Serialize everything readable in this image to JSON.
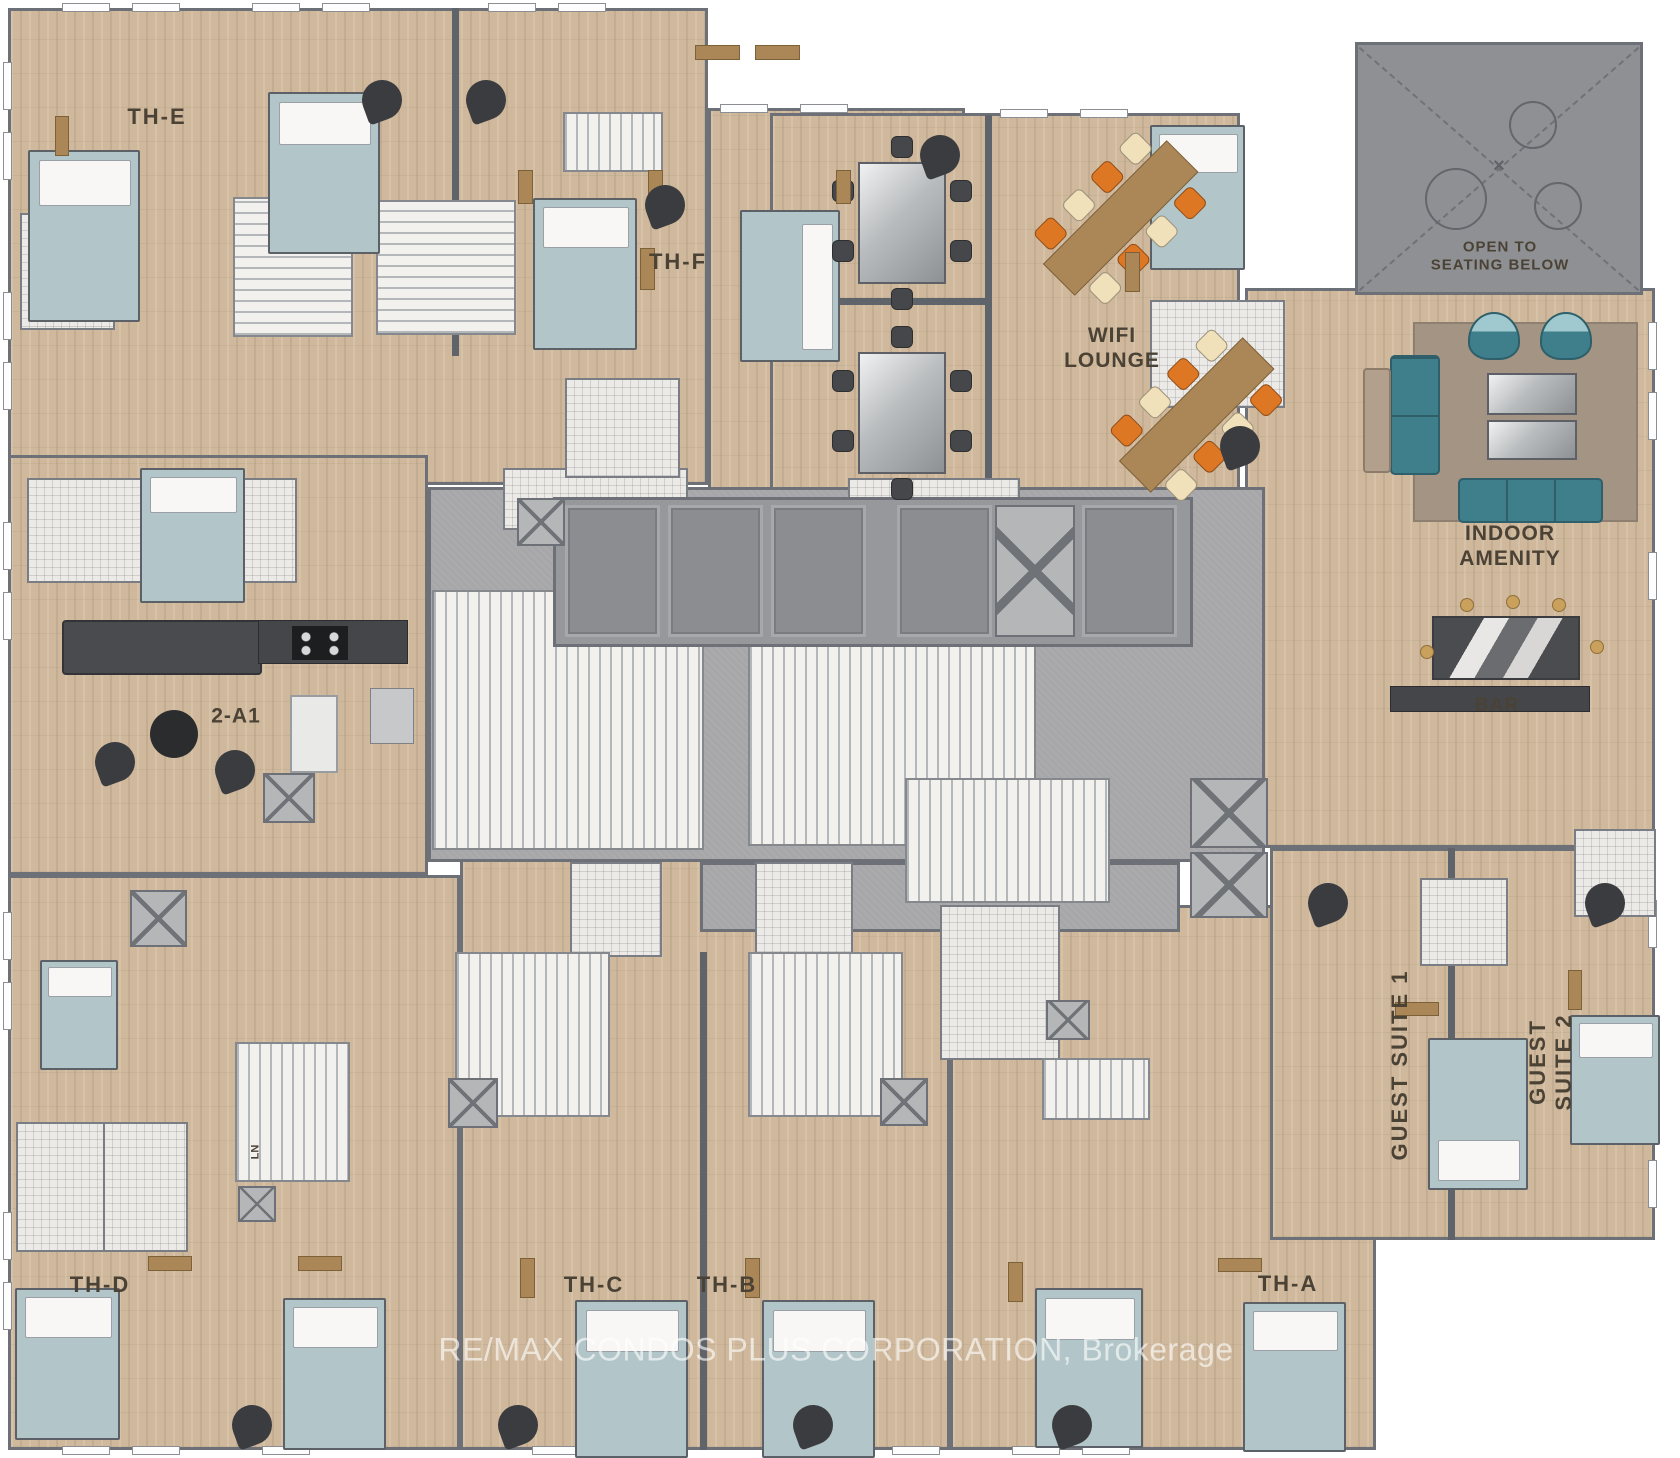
{
  "watermark": "RE/MAX CONDOS PLUS CORPORATION, Brokerage",
  "palette": {
    "wood": "#cfb89b",
    "wall": "#6d7177",
    "corridor": "#a7a6a9",
    "open_below": "#8f9093",
    "bed": "#b2c5c8",
    "sofa_teal": "#3f7e8b",
    "chair_orange": "#dd7724",
    "chair_cream": "#f1e1ba",
    "chair_dark": "#45474b",
    "table_wood": "#ab8758",
    "rug": "#a39483",
    "label_text": "#4b4236"
  },
  "labels": [
    {
      "text": "TH-E",
      "x": 157,
      "y": 117,
      "size": 22,
      "spacing": 2,
      "rotate": 0
    },
    {
      "text": "TH-F",
      "x": 678,
      "y": 262,
      "size": 22,
      "spacing": 2,
      "rotate": 0
    },
    {
      "text": "WIFI\nLOUNGE",
      "x": 1112,
      "y": 349,
      "size": 21,
      "spacing": 1,
      "rotate": 0
    },
    {
      "text": "OPEN TO\nSEATING BELOW",
      "x": 1500,
      "y": 256,
      "size": 15,
      "spacing": 1,
      "rotate": 0
    },
    {
      "text": "INDOOR AMENITY",
      "x": 1510,
      "y": 547,
      "size": 21,
      "spacing": 1,
      "rotate": 0
    },
    {
      "text": "BAR",
      "x": 1497,
      "y": 706,
      "size": 19,
      "spacing": 1,
      "rotate": 0
    },
    {
      "text": "2-A1",
      "x": 236,
      "y": 717,
      "size": 21,
      "spacing": 1,
      "rotate": 0
    },
    {
      "text": "LN",
      "x": 256,
      "y": 1152,
      "size": 11,
      "spacing": 0,
      "rotate": -90
    },
    {
      "text": "TH-D",
      "x": 100,
      "y": 1285,
      "size": 22,
      "spacing": 2,
      "rotate": 0
    },
    {
      "text": "TH-C",
      "x": 594,
      "y": 1285,
      "size": 22,
      "spacing": 2,
      "rotate": 0
    },
    {
      "text": "TH-B",
      "x": 727,
      "y": 1285,
      "size": 22,
      "spacing": 2,
      "rotate": 0
    },
    {
      "text": "TH-A",
      "x": 1288,
      "y": 1284,
      "size": 22,
      "spacing": 2,
      "rotate": 0
    },
    {
      "text": "GUEST SUITE 1",
      "x": 1400,
      "y": 1065,
      "size": 22,
      "spacing": 2,
      "rotate": -90
    },
    {
      "text": "GUEST SUITE 2",
      "x": 1551,
      "y": 1062,
      "size": 22,
      "spacing": 2,
      "rotate": -90
    }
  ],
  "regions": [
    {
      "k": "wood",
      "x": 8,
      "y": 8,
      "w": 700,
      "h": 477
    },
    {
      "k": "wood",
      "x": 708,
      "y": 108,
      "w": 257,
      "h": 385
    },
    {
      "k": "wood",
      "x": 770,
      "y": 113,
      "w": 470,
      "h": 392
    },
    {
      "k": "wood",
      "x": 1245,
      "y": 288,
      "w": 410,
      "h": 560
    },
    {
      "k": "wood",
      "x": 8,
      "y": 455,
      "w": 420,
      "h": 420
    },
    {
      "k": "wood",
      "x": 8,
      "y": 875,
      "w": 452,
      "h": 575
    },
    {
      "k": "wood",
      "x": 460,
      "y": 858,
      "w": 490,
      "h": 592
    },
    {
      "k": "wood",
      "x": 950,
      "y": 905,
      "w": 426,
      "h": 545
    },
    {
      "k": "wood",
      "x": 1270,
      "y": 848,
      "w": 385,
      "h": 392
    },
    {
      "k": "corridor",
      "x": 428,
      "y": 487,
      "w": 837,
      "h": 375
    },
    {
      "k": "corridor",
      "x": 700,
      "y": 862,
      "w": 480,
      "h": 70
    },
    {
      "k": "openbelow",
      "x": 1355,
      "y": 42,
      "w": 288,
      "h": 253
    }
  ],
  "walls": [
    [
      452,
      8,
      7,
      348
    ],
    [
      985,
      115,
      7,
      390
    ],
    [
      770,
      298,
      218,
      7
    ],
    [
      700,
      952,
      7,
      498
    ],
    [
      1448,
      848,
      7,
      392
    ]
  ],
  "windows": [
    [
      62,
      3,
      48,
      9
    ],
    [
      132,
      3,
      48,
      9
    ],
    [
      252,
      3,
      48,
      9
    ],
    [
      322,
      3,
      48,
      9
    ],
    [
      488,
      3,
      48,
      9
    ],
    [
      558,
      3,
      48,
      9
    ],
    [
      720,
      104,
      48,
      9
    ],
    [
      800,
      104,
      48,
      9
    ],
    [
      1000,
      109,
      48,
      9
    ],
    [
      1080,
      109,
      48,
      9
    ],
    [
      3,
      62,
      9,
      48
    ],
    [
      3,
      132,
      9,
      48
    ],
    [
      3,
      292,
      9,
      48
    ],
    [
      3,
      362,
      9,
      48
    ],
    [
      3,
      522,
      9,
      48
    ],
    [
      3,
      592,
      9,
      48
    ],
    [
      3,
      912,
      9,
      48
    ],
    [
      3,
      982,
      9,
      48
    ],
    [
      3,
      1212,
      9,
      48
    ],
    [
      3,
      1282,
      9,
      48
    ],
    [
      62,
      1446,
      48,
      9
    ],
    [
      132,
      1446,
      48,
      9
    ],
    [
      262,
      1446,
      48,
      9
    ],
    [
      532,
      1446,
      48,
      9
    ],
    [
      602,
      1446,
      48,
      9
    ],
    [
      822,
      1446,
      48,
      9
    ],
    [
      892,
      1446,
      48,
      9
    ],
    [
      1012,
      1446,
      48,
      9
    ],
    [
      1082,
      1446,
      48,
      9
    ],
    [
      1648,
      322,
      9,
      48
    ],
    [
      1648,
      392,
      9,
      48
    ],
    [
      1648,
      552,
      9,
      48
    ],
    [
      1648,
      900,
      9,
      48
    ],
    [
      1648,
      1090,
      9,
      48
    ],
    [
      1648,
      1160,
      9,
      48
    ]
  ],
  "tiles": [
    [
      20,
      213,
      95,
      117
    ],
    [
      27,
      478,
      270,
      105
    ],
    [
      503,
      468,
      185,
      62
    ],
    [
      565,
      378,
      115,
      100
    ],
    [
      848,
      478,
      172,
      58
    ],
    [
      1150,
      300,
      135,
      108
    ],
    [
      570,
      862,
      92,
      95
    ],
    [
      755,
      862,
      98,
      95
    ],
    [
      940,
      905,
      120,
      155
    ],
    [
      16,
      1122,
      90,
      130
    ],
    [
      103,
      1122,
      85,
      130
    ],
    [
      1420,
      878,
      88,
      88
    ],
    [
      1574,
      829,
      82,
      88
    ]
  ],
  "stairs": [
    [
      233,
      197,
      120,
      140,
      "h"
    ],
    [
      376,
      200,
      140,
      135,
      "h"
    ],
    [
      563,
      112,
      100,
      60,
      "v"
    ],
    [
      432,
      590,
      272,
      260,
      "v"
    ],
    [
      748,
      578,
      288,
      268,
      "v"
    ],
    [
      905,
      778,
      205,
      125,
      "v"
    ],
    [
      235,
      1042,
      115,
      140,
      "v"
    ],
    [
      455,
      952,
      155,
      165,
      "v"
    ],
    [
      748,
      952,
      155,
      165,
      "v"
    ],
    [
      1042,
      1058,
      108,
      62,
      "v"
    ]
  ],
  "elevator_bank": {
    "x": 553,
    "y": 497,
    "w": 640,
    "h": 150,
    "cars": [
      [
        565,
        505,
        95,
        132
      ],
      [
        668,
        505,
        95,
        132
      ],
      [
        771,
        505,
        95,
        132
      ],
      [
        897,
        505,
        95,
        132
      ],
      [
        1082,
        505,
        95,
        132
      ]
    ],
    "xshaft": [
      995,
      505,
      80,
      132
    ]
  },
  "shafts": [
    [
      517,
      498,
      48,
      48
    ],
    [
      263,
      773,
      52,
      50
    ],
    [
      130,
      890,
      57,
      57
    ],
    [
      448,
      1078,
      50,
      50
    ],
    [
      880,
      1078,
      48,
      48
    ],
    [
      1046,
      1000,
      44,
      40
    ],
    [
      238,
      1186,
      38,
      36
    ],
    [
      1190,
      778,
      78,
      70
    ],
    [
      1190,
      852,
      78,
      66
    ]
  ],
  "open_below": {
    "circles": [
      [
        1425,
        168,
        62
      ],
      [
        1509,
        101,
        48
      ],
      [
        1534,
        182,
        48
      ]
    ],
    "cross": "×",
    "cross_x": 1499,
    "cross_y": 167
  },
  "furniture": {
    "beds": [
      [
        28,
        150,
        112,
        172,
        "n"
      ],
      [
        268,
        92,
        112,
        162,
        "n"
      ],
      [
        533,
        198,
        104,
        152,
        "n"
      ],
      [
        740,
        210,
        100,
        152,
        "e"
      ],
      [
        1150,
        125,
        95,
        145,
        "n"
      ],
      [
        140,
        468,
        105,
        135,
        "n"
      ],
      [
        40,
        960,
        78,
        110,
        "n"
      ],
      [
        15,
        1288,
        105,
        152,
        "n"
      ],
      [
        283,
        1298,
        103,
        152,
        "n"
      ],
      [
        575,
        1300,
        113,
        158,
        "n"
      ],
      [
        762,
        1300,
        113,
        158,
        "n"
      ],
      [
        1035,
        1288,
        108,
        160,
        "n"
      ],
      [
        1243,
        1302,
        103,
        150,
        "n"
      ],
      [
        1428,
        1038,
        100,
        152,
        "s"
      ],
      [
        1570,
        1015,
        90,
        130,
        "n"
      ]
    ],
    "sofas_teal": [
      [
        1390,
        355,
        50,
        120
      ],
      [
        1458,
        478,
        145,
        45
      ]
    ],
    "sofas_dark": [
      [
        62,
        620,
        200,
        55
      ]
    ],
    "armchairs": [
      [
        1468,
        312,
        52,
        48
      ],
      [
        1540,
        312,
        52,
        48
      ]
    ],
    "chaise": [
      1363,
      368,
      28,
      105
    ],
    "rug": [
      1413,
      322,
      225,
      200
    ],
    "coffee_tables": [
      [
        1487,
        373,
        90,
        42
      ],
      [
        1487,
        420,
        90,
        40
      ]
    ],
    "glass_tables": [
      [
        858,
        162,
        88,
        122
      ],
      [
        858,
        352,
        88,
        122
      ]
    ],
    "wifi_tables": {
      "len": 175,
      "wid": 45,
      "angle": -45,
      "centers": [
        [
          1120,
          218
        ],
        [
          1196,
          415
        ]
      ]
    },
    "bar": {
      "island": [
        1432,
        616,
        148,
        64
      ],
      "counter": [
        1390,
        686,
        200,
        26
      ],
      "stools": [
        [
          1460,
          598
        ],
        [
          1506,
          595
        ],
        [
          1552,
          598
        ],
        [
          1420,
          645
        ],
        [
          1590,
          640
        ]
      ]
    },
    "kitchen": {
      "counter": [
        258,
        620,
        150,
        44
      ],
      "stove": [
        292,
        626,
        56,
        34
      ],
      "fridge": [
        370,
        688,
        44,
        56
      ]
    },
    "round_table": [
      150,
      710,
      48
    ],
    "small_table": [
      290,
      695,
      48,
      78
    ],
    "dressers": [
      [
        695,
        45,
        45,
        15
      ],
      [
        755,
        45,
        45,
        15
      ],
      [
        640,
        248,
        15,
        42
      ],
      [
        518,
        170,
        15,
        34
      ],
      [
        648,
        170,
        15,
        34
      ],
      [
        836,
        170,
        15,
        34
      ],
      [
        1125,
        252,
        15,
        40
      ],
      [
        148,
        1256,
        44,
        15
      ],
      [
        298,
        1256,
        44,
        15
      ],
      [
        520,
        1258,
        15,
        40
      ],
      [
        745,
        1258,
        15,
        40
      ],
      [
        1008,
        1262,
        15,
        40
      ],
      [
        1218,
        1258,
        44,
        14
      ],
      [
        1395,
        1002,
        44,
        14
      ],
      [
        1568,
        970,
        14,
        40
      ],
      [
        55,
        116,
        14,
        40
      ]
    ],
    "teardrops": [
      [
        362,
        80
      ],
      [
        466,
        80
      ],
      [
        920,
        135
      ],
      [
        645,
        185
      ],
      [
        1220,
        426
      ],
      [
        95,
        742
      ],
      [
        215,
        750
      ],
      [
        232,
        1405
      ],
      [
        498,
        1405
      ],
      [
        793,
        1405
      ],
      [
        1052,
        1405
      ],
      [
        1308,
        883
      ],
      [
        1585,
        883
      ]
    ]
  }
}
